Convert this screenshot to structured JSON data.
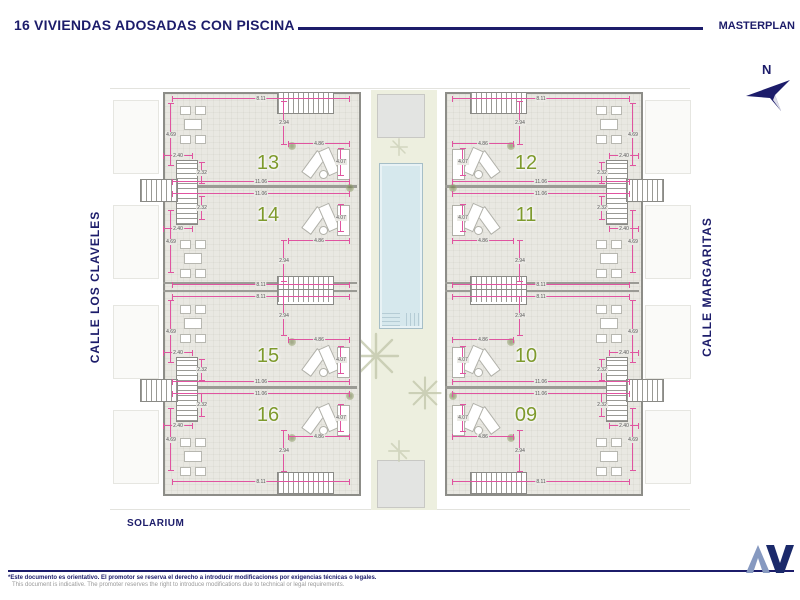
{
  "header": {
    "title": "16 VIVIENDAS ADOSADAS CON PISCINA",
    "right_label": "MASTERPLAN"
  },
  "compass": {
    "label": "N"
  },
  "streets": {
    "left": "CALLE LOS CLAVELES",
    "right": "CALLE MARGARITAS"
  },
  "plan": {
    "units": [
      {
        "number": "13"
      },
      {
        "number": "14"
      },
      {
        "number": "15"
      },
      {
        "number": "16"
      },
      {
        "number": "12"
      },
      {
        "number": "11"
      },
      {
        "number": "10"
      },
      {
        "number": "09"
      }
    ],
    "dims": {
      "unit_width": "8.11",
      "unit_full_width": "11.06",
      "terrace_depth": "4.69",
      "entry_depth": "2.94",
      "lounge_width": "4.86",
      "lounge_depth": "4.07",
      "stair_width": "2.40",
      "stair_depth": "2.32"
    },
    "labels": {
      "solarium": "SOLARIUM"
    }
  },
  "footer": {
    "disclaimer_es": "*Este documento es orientativo. El promotor se reserva el derecho a introducir modificaciones por exigencias técnicas o legales.",
    "disclaimer_en": "This document is indicative. The promoter reserves the right to introduce modifications due to technical or legal requirements."
  },
  "colors": {
    "navy": "#1c1c6a",
    "dim_magenta": "#e054a0",
    "unit_green": "#7e9a2d",
    "pool_blue": "#d6e8ed",
    "courtyard_green": "#edefdf"
  }
}
